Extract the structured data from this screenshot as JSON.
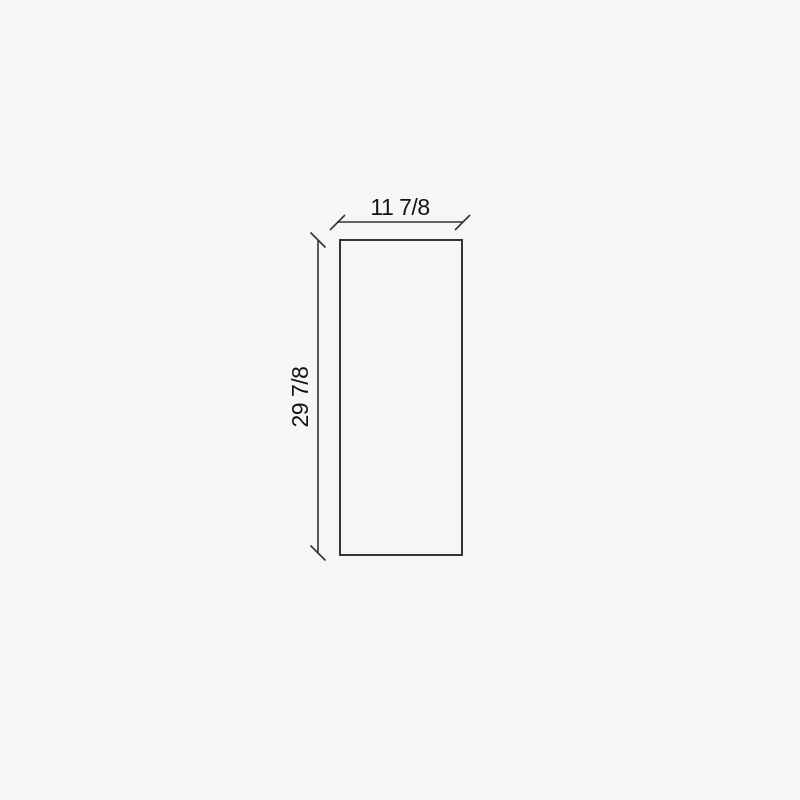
{
  "diagram": {
    "type": "dimensioned-rectangle",
    "width_dimension": {
      "label": "11 7/8"
    },
    "height_dimension": {
      "label": "29 7/8"
    },
    "colors": {
      "background": "#f6f6f6",
      "outline": "#343434",
      "dimension_line": "#333333",
      "text": "#141414"
    }
  }
}
